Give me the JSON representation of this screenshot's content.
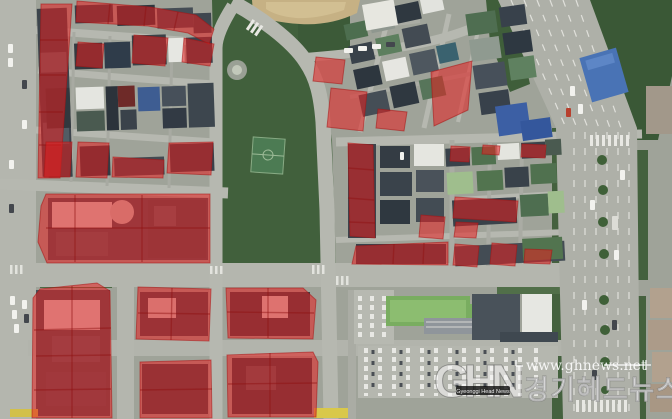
{
  "image_type": "aerial-satellite-photo-with-highlighted-parcels",
  "watermark": {
    "logo_text": "GHN",
    "logo_subtext": "Gyeonggi Head News",
    "url": "www.ghnews.net",
    "site_name": "경기헤드뉴스"
  },
  "overlay": {
    "fill": "#e51f1f",
    "fill_opacity": 0.55,
    "stroke": "#a81414",
    "line_color": "#8f1010",
    "regions": [
      {
        "id": "strip-west",
        "points": [
          [
            41,
            4
          ],
          [
            72,
            4
          ],
          [
            60,
            178
          ],
          [
            38,
            178
          ]
        ],
        "lines": [
          [
            40,
            40,
            68,
            40
          ],
          [
            40,
            75,
            66,
            75
          ],
          [
            39,
            112,
            63,
            112
          ],
          [
            39,
            145,
            61,
            145
          ]
        ]
      },
      {
        "id": "band-north",
        "points": [
          [
            77,
            1
          ],
          [
            150,
            7
          ],
          [
            196,
            15
          ],
          [
            214,
            29
          ],
          [
            209,
            44
          ],
          [
            188,
            33
          ],
          [
            148,
            26
          ],
          [
            76,
            22
          ]
        ],
        "lines": [
          [
            110,
            4,
            108,
            24
          ],
          [
            146,
            7,
            144,
            26
          ],
          [
            178,
            12,
            174,
            30
          ]
        ]
      },
      {
        "id": "cell-nw-1",
        "points": [
          [
            78,
            42
          ],
          [
            104,
            44
          ],
          [
            102,
            68
          ],
          [
            76,
            66
          ]
        ]
      },
      {
        "id": "cell-nw-2",
        "points": [
          [
            134,
            35
          ],
          [
            168,
            38
          ],
          [
            165,
            66
          ],
          [
            132,
            63
          ]
        ]
      },
      {
        "id": "cell-nw-3",
        "points": [
          [
            184,
            38
          ],
          [
            214,
            44
          ],
          [
            210,
            66
          ],
          [
            182,
            62
          ]
        ]
      },
      {
        "id": "row-cell-1",
        "points": [
          [
            46,
            142
          ],
          [
            72,
            142
          ],
          [
            70,
            177
          ],
          [
            44,
            177
          ]
        ]
      },
      {
        "id": "row-cell-2",
        "points": [
          [
            78,
            142
          ],
          [
            109,
            143
          ],
          [
            107,
            178
          ],
          [
            76,
            177
          ]
        ]
      },
      {
        "id": "row-cell-3",
        "points": [
          [
            113,
            157
          ],
          [
            164,
            160
          ],
          [
            163,
            178
          ],
          [
            112,
            177
          ]
        ]
      },
      {
        "id": "row-cell-4",
        "points": [
          [
            169,
            143
          ],
          [
            213,
            142
          ],
          [
            211,
            175
          ],
          [
            167,
            173
          ]
        ]
      },
      {
        "id": "block-central-west",
        "points": [
          [
            46,
            194
          ],
          [
            210,
            194
          ],
          [
            210,
            263
          ],
          [
            47,
            263
          ],
          [
            38,
            242
          ],
          [
            41,
            206
          ]
        ],
        "lines": [
          [
            142,
            195,
            142,
            262
          ],
          [
            46,
            228,
            210,
            228
          ],
          [
            75,
            195,
            75,
            262
          ]
        ]
      },
      {
        "id": "cell-mid-north-1",
        "points": [
          [
            316,
            57
          ],
          [
            345,
            60
          ],
          [
            342,
            84
          ],
          [
            313,
            81
          ]
        ]
      },
      {
        "id": "cell-mid-north-2",
        "points": [
          [
            331,
            88
          ],
          [
            367,
            92
          ],
          [
            363,
            131
          ],
          [
            327,
            127
          ]
        ]
      },
      {
        "id": "cell-ne-lean",
        "points": [
          [
            431,
            72
          ],
          [
            472,
            61
          ],
          [
            468,
            110
          ],
          [
            434,
            126
          ]
        ]
      },
      {
        "id": "cell-mid-north-3",
        "points": [
          [
            378,
            109
          ],
          [
            407,
            112
          ],
          [
            404,
            131
          ],
          [
            376,
            128
          ]
        ]
      },
      {
        "id": "strip-park-east",
        "points": [
          [
            348,
            143
          ],
          [
            373,
            145
          ],
          [
            375,
            238
          ],
          [
            350,
            236
          ]
        ],
        "lines": [
          [
            348,
            168,
            374,
            170
          ],
          [
            348,
            198,
            374,
            200
          ],
          [
            349,
            222,
            375,
            223
          ]
        ]
      },
      {
        "id": "cell-east-1",
        "points": [
          [
            421,
            215
          ],
          [
            445,
            217
          ],
          [
            443,
            239
          ],
          [
            419,
            237
          ]
        ]
      },
      {
        "id": "band-south-1",
        "points": [
          [
            356,
            246
          ],
          [
            448,
            242
          ],
          [
            448,
            265
          ],
          [
            352,
            264
          ]
        ],
        "lines": [
          [
            394,
            244,
            393,
            264
          ],
          [
            424,
            243,
            423,
            264
          ]
        ]
      },
      {
        "id": "band-south-2",
        "points": [
          [
            455,
            244
          ],
          [
            479,
            246
          ],
          [
            477,
            267
          ],
          [
            453,
            265
          ]
        ]
      },
      {
        "id": "band-south-3",
        "points": [
          [
            492,
            243
          ],
          [
            517,
            245
          ],
          [
            515,
            266
          ],
          [
            490,
            264
          ]
        ]
      },
      {
        "id": "band-south-4",
        "points": [
          [
            525,
            249
          ],
          [
            552,
            250
          ],
          [
            550,
            264
          ],
          [
            524,
            263
          ]
        ]
      },
      {
        "id": "cell-east-2",
        "points": [
          [
            455,
            197
          ],
          [
            518,
            201
          ],
          [
            516,
            222
          ],
          [
            453,
            218
          ]
        ]
      },
      {
        "id": "cell-east-3",
        "points": [
          [
            456,
            222
          ],
          [
            478,
            223
          ],
          [
            476,
            238
          ],
          [
            454,
            237
          ]
        ]
      },
      {
        "id": "cell-east-4",
        "points": [
          [
            451,
            146
          ],
          [
            470,
            147
          ],
          [
            469,
            162
          ],
          [
            450,
            161
          ]
        ]
      },
      {
        "id": "cell-east-5",
        "points": [
          [
            522,
            144
          ],
          [
            546,
            145
          ],
          [
            545,
            158
          ],
          [
            521,
            157
          ]
        ]
      },
      {
        "id": "cell-east-6",
        "points": [
          [
            483,
            145
          ],
          [
            500,
            146
          ],
          [
            499,
            155
          ],
          [
            482,
            154
          ]
        ]
      },
      {
        "id": "block-sw",
        "points": [
          [
            40,
            289
          ],
          [
            97,
            283
          ],
          [
            110,
            291
          ],
          [
            112,
            418
          ],
          [
            32,
            418
          ],
          [
            33,
            298
          ]
        ],
        "lines": [
          [
            34,
            330,
            111,
            328
          ],
          [
            36,
            356,
            111,
            355
          ],
          [
            34,
            390,
            111,
            389
          ],
          [
            72,
            286,
            72,
            418
          ]
        ]
      },
      {
        "id": "block-s-1",
        "points": [
          [
            138,
            287
          ],
          [
            211,
            289
          ],
          [
            209,
            341
          ],
          [
            136,
            339
          ]
        ],
        "lines": [
          [
            138,
            313,
            210,
            314
          ],
          [
            172,
            288,
            171,
            340
          ]
        ]
      },
      {
        "id": "block-s-2",
        "points": [
          [
            226,
            288
          ],
          [
            303,
            288
          ],
          [
            316,
            300
          ],
          [
            313,
            339
          ],
          [
            228,
            338
          ]
        ],
        "lines": [
          [
            227,
            312,
            314,
            313
          ],
          [
            268,
            288,
            268,
            338
          ]
        ]
      },
      {
        "id": "block-s-3",
        "points": [
          [
            140,
            362
          ],
          [
            211,
            360
          ],
          [
            212,
            418
          ],
          [
            140,
            418
          ]
        ],
        "lines": [
          [
            140,
            390,
            212,
            389
          ]
        ]
      },
      {
        "id": "block-s-4",
        "points": [
          [
            227,
            355
          ],
          [
            313,
            352
          ],
          [
            318,
            362
          ],
          [
            316,
            417
          ],
          [
            228,
            417
          ]
        ],
        "lines": [
          [
            228,
            384,
            317,
            383
          ],
          [
            270,
            353,
            270,
            417
          ]
        ]
      }
    ]
  }
}
